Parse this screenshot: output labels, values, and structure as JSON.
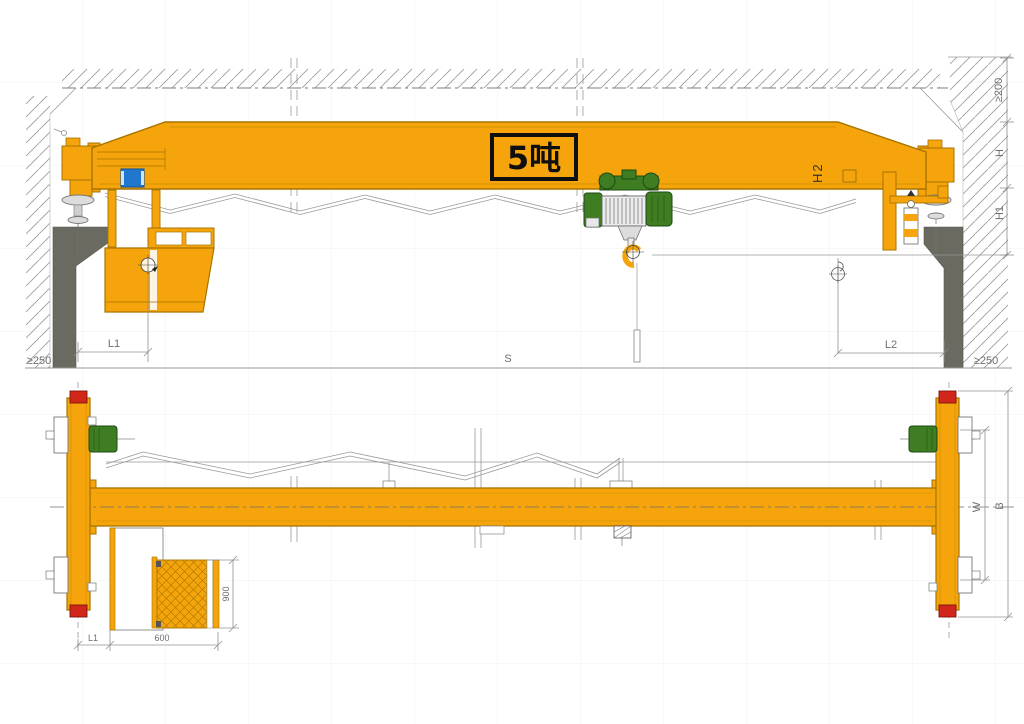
{
  "colors": {
    "crane_yellow": "#F5A50B",
    "outline_brown": "#A87400",
    "hoist_green": "#3F7D23",
    "buffer_red": "#D2261A",
    "column_gray": "#6A6A61",
    "component_blue": "#2176CE",
    "line_gray": "#8C8C8C",
    "label_black": "#111111"
  },
  "front_view": {
    "capacity_label": "5吨",
    "dims": {
      "ceiling_clearance": "≥200",
      "height_h": "H",
      "hook_height_h1": "H1",
      "girder_height_h2": "H2",
      "left_approach_l1": "L1",
      "span_s": "S",
      "right_approach_l2": "L2",
      "side_clearance_left": "≥250",
      "side_clearance_right": "≥250"
    }
  },
  "plan_view": {
    "dims": {
      "wheelbase_w": "W",
      "carriage_length_b": "B",
      "cab_depth": "900",
      "cab_width": "600",
      "cab_offset_l1": "L1"
    }
  }
}
